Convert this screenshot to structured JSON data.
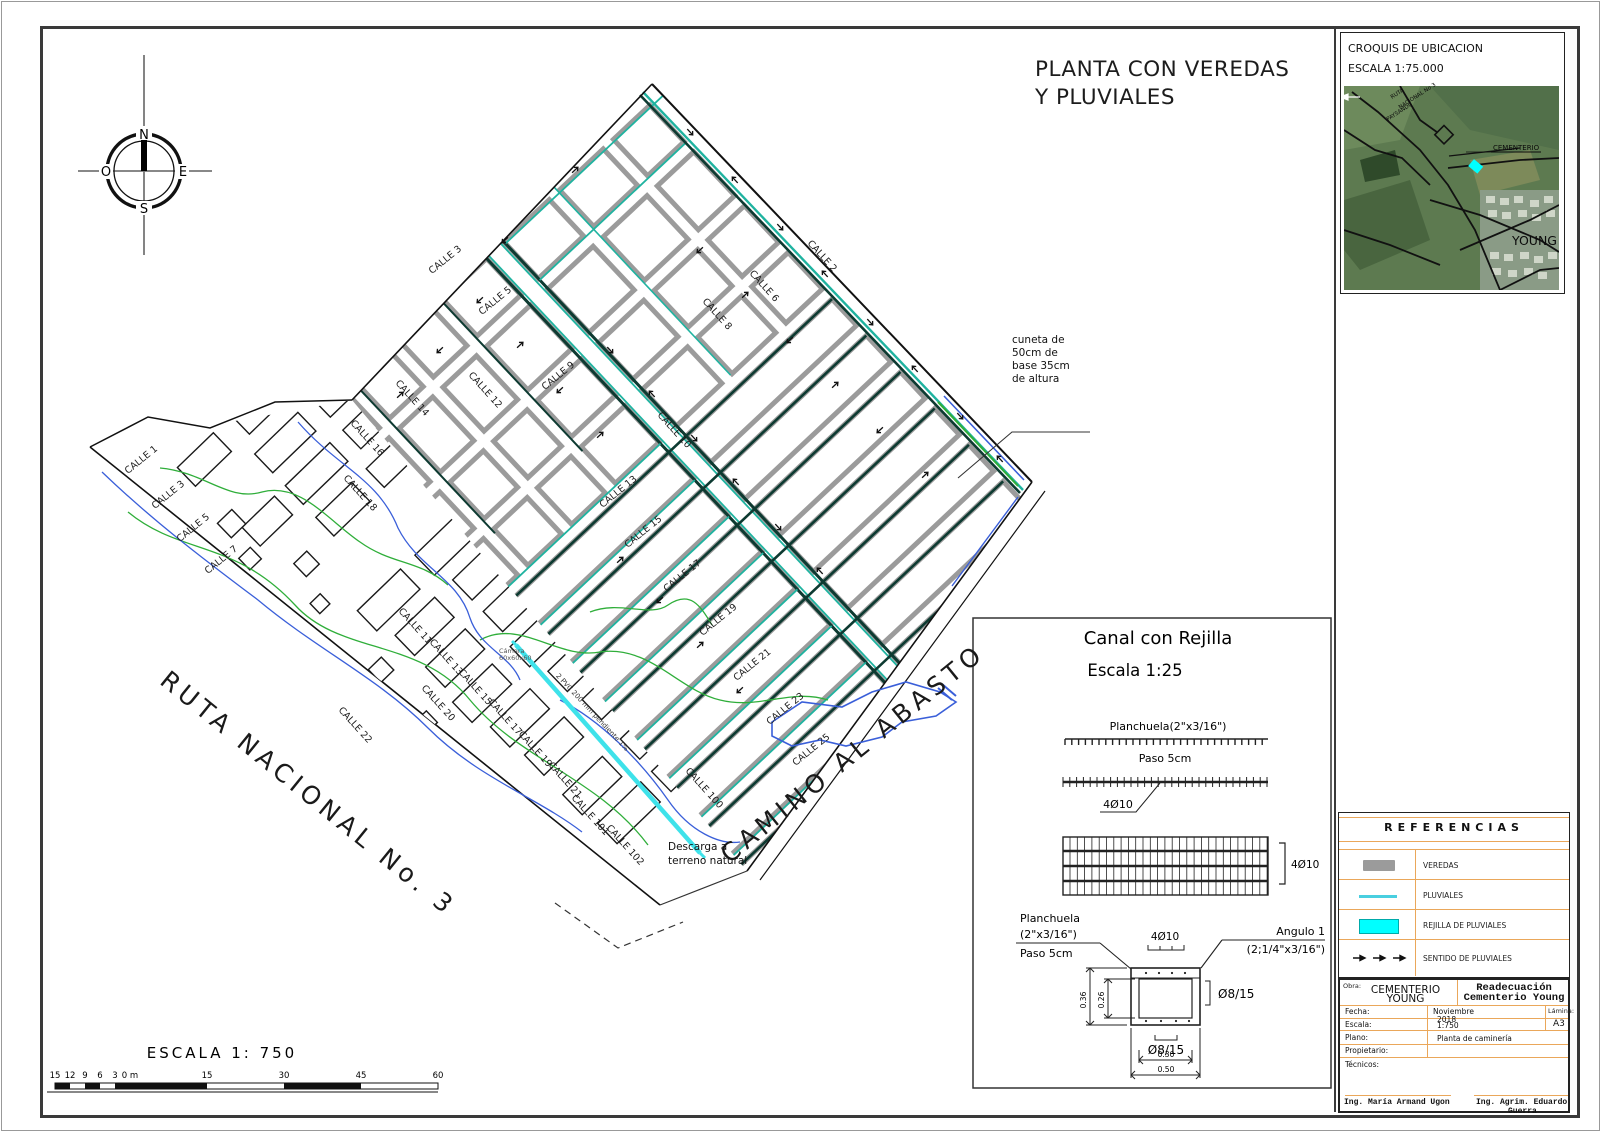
{
  "sheet": {
    "title_line1": "PLANTA CON VEREDAS",
    "title_line2": "Y PLUVIALES"
  },
  "compass": {
    "n": "N",
    "e": "E",
    "s": "S",
    "o": "O"
  },
  "croquis": {
    "title": "CROQUIS DE UBICACION",
    "scale": "ESCALA 1:75.000",
    "labels": [
      {
        "t": "RUTA",
        "x": 1392,
        "y": 99,
        "a": -33,
        "s": 5.5
      },
      {
        "t": "NACIONAL No 3",
        "x": 1400,
        "y": 109,
        "a": -33,
        "s": 5.5
      },
      {
        "t": "PAYSANDU",
        "x": 1388,
        "y": 121,
        "a": -33,
        "s": 5.5
      },
      {
        "t": "CEMENTERIO",
        "x": 1493,
        "y": 150,
        "a": 0,
        "s": 7
      },
      {
        "t": "YOUNG",
        "x": 1512,
        "y": 245,
        "a": 0,
        "s": 12.5
      }
    ]
  },
  "plan": {
    "labels": [
      {
        "t": "CALLE 3",
        "x": 447,
        "y": 262,
        "a": -39
      },
      {
        "t": "CALLE 5",
        "x": 497,
        "y": 303,
        "a": -39
      },
      {
        "t": "CALLE 9",
        "x": 560,
        "y": 378,
        "a": -39
      },
      {
        "t": "CALLE 12",
        "x": 483,
        "y": 392,
        "a": 48
      },
      {
        "t": "CALLE 14",
        "x": 410,
        "y": 400,
        "a": 48
      },
      {
        "t": "CALLE 16",
        "x": 365,
        "y": 440,
        "a": 48
      },
      {
        "t": "CALLE 18",
        "x": 358,
        "y": 495,
        "a": 48
      },
      {
        "t": "CALLE 10",
        "x": 672,
        "y": 432,
        "a": 48
      },
      {
        "t": "CALLE 2",
        "x": 820,
        "y": 258,
        "a": 48
      },
      {
        "t": "CALLE 6",
        "x": 762,
        "y": 288,
        "a": 48
      },
      {
        "t": "CALLE 8",
        "x": 715,
        "y": 316,
        "a": 48
      },
      {
        "t": "CALLE 13",
        "x": 620,
        "y": 494,
        "a": -39
      },
      {
        "t": "CALLE 15",
        "x": 645,
        "y": 534,
        "a": -39
      },
      {
        "t": "CALLE 17",
        "x": 684,
        "y": 578,
        "a": -39
      },
      {
        "t": "CALLE 19",
        "x": 720,
        "y": 622,
        "a": -39
      },
      {
        "t": "CALLE 21",
        "x": 754,
        "y": 667,
        "a": -39
      },
      {
        "t": "CALLE 23",
        "x": 787,
        "y": 711,
        "a": -39
      },
      {
        "t": "CALLE 25",
        "x": 813,
        "y": 752,
        "a": -39
      },
      {
        "t": "CALLE 1",
        "x": 143,
        "y": 462,
        "a": -39
      },
      {
        "t": "CALLE 3",
        "x": 170,
        "y": 497,
        "a": -39
      },
      {
        "t": "CALLE 5",
        "x": 195,
        "y": 530,
        "a": -39
      },
      {
        "t": "CALLE 7",
        "x": 223,
        "y": 562,
        "a": -39
      },
      {
        "t": "CALLE 11",
        "x": 413,
        "y": 628,
        "a": 48
      },
      {
        "t": "CALLE 13",
        "x": 444,
        "y": 659,
        "a": 48
      },
      {
        "t": "CALLE 15",
        "x": 473,
        "y": 689,
        "a": 48
      },
      {
        "t": "CALLE 17",
        "x": 503,
        "y": 719,
        "a": 48
      },
      {
        "t": "CALLE 19",
        "x": 533,
        "y": 751,
        "a": 48
      },
      {
        "t": "CALLE 21",
        "x": 563,
        "y": 782,
        "a": 48
      },
      {
        "t": "CALLE 101",
        "x": 588,
        "y": 817,
        "a": 48
      },
      {
        "t": "CALLE 102",
        "x": 623,
        "y": 847,
        "a": 48
      },
      {
        "t": "CALLE 100",
        "x": 702,
        "y": 790,
        "a": 48
      },
      {
        "t": "CALLE 20",
        "x": 436,
        "y": 705,
        "a": 48
      },
      {
        "t": "CALLE 22",
        "x": 353,
        "y": 727,
        "a": 48
      },
      {
        "t": "RUTA NACIONAL No. 3",
        "x": 303,
        "y": 800,
        "a": 39,
        "s": 25,
        "ls": 5
      },
      {
        "t": "CAMINO AL ABASTO",
        "x": 858,
        "y": 760,
        "a": -39,
        "s": 25,
        "ls": 5
      }
    ],
    "annotations": {
      "cuneta": [
        "cuneta de",
        "50cm de",
        "base 35cm",
        "de altura"
      ],
      "camara": [
        "Cámara",
        "60x60x60"
      ],
      "pvc": "2 PVC 200 mm pendiente 1%",
      "descarga": [
        "Descarga a",
        "terreno natural"
      ]
    }
  },
  "scalebar": {
    "title": "ESCALA 1: 750",
    "left_labels": [
      "15",
      "12",
      "9",
      "6",
      "3",
      "0 m"
    ],
    "right_labels": [
      "15",
      "30",
      "45",
      "60"
    ]
  },
  "detail": {
    "title": "Canal con Rejilla",
    "scale": "Escala 1:25",
    "planchuela_top": "Planchuela(2\"x3/16\")",
    "paso_top": "Paso 5cm",
    "bar_label": "4Ø10",
    "grid_label": "4Ø10",
    "sec_top_label": "4Ø10",
    "planchuela_side": [
      "Planchuela",
      "(2\"x3/16\")",
      "Paso 5cm"
    ],
    "angulo": [
      "Angulo 1",
      "(2;1/4\"x3/16\")"
    ],
    "rebar_side": "Ø8/15",
    "rebar_bottom": "Ø8/15",
    "dim_out_h": "0.36",
    "dim_in_h": "0.26",
    "dim_in_w": "0.30",
    "dim_out_w": "0.50"
  },
  "references": {
    "title": "REFERENCIAS",
    "items": [
      {
        "label": "VEREDAS"
      },
      {
        "label": "PLUVIALES"
      },
      {
        "label": "REJILLA DE PLUVIALES"
      },
      {
        "label": "SENTIDO DE PLUVIALES"
      }
    ]
  },
  "titleblock": {
    "obra_label": "Obra:",
    "obra_line1": "CEMENTERIO",
    "obra_line2": "YOUNG",
    "proj_line1": "Readecuación",
    "proj_line2": "Cementerio Young",
    "fecha_label": "Fecha:",
    "fecha_value1": "Noviembre",
    "fecha_value2": "2018",
    "escala_label": "Escala:",
    "escala_value": "1:750",
    "lamina_label": "Lámina:",
    "lamina_value": "A3",
    "plano_label": "Plano:",
    "plano_value": "Planta de caminería",
    "propietario_label": "Propietario:",
    "tecnicos_label": "Técnicos:",
    "sig1": "Ing. María Armand Ugon",
    "sig2": "Ing. Agrim. Eduardo",
    "sig2b": "Guerra"
  },
  "colors": {
    "vereda_gray": "#9b9b9b",
    "pluvial_teal": "#1fb3a0",
    "rejilla_cyan": "#00ffff",
    "pipe_cyan": "#3ee2ea",
    "contour_blue": "#3a5fd9",
    "contour_green": "#2fae3a",
    "grid_orange": "#eaa75a"
  }
}
